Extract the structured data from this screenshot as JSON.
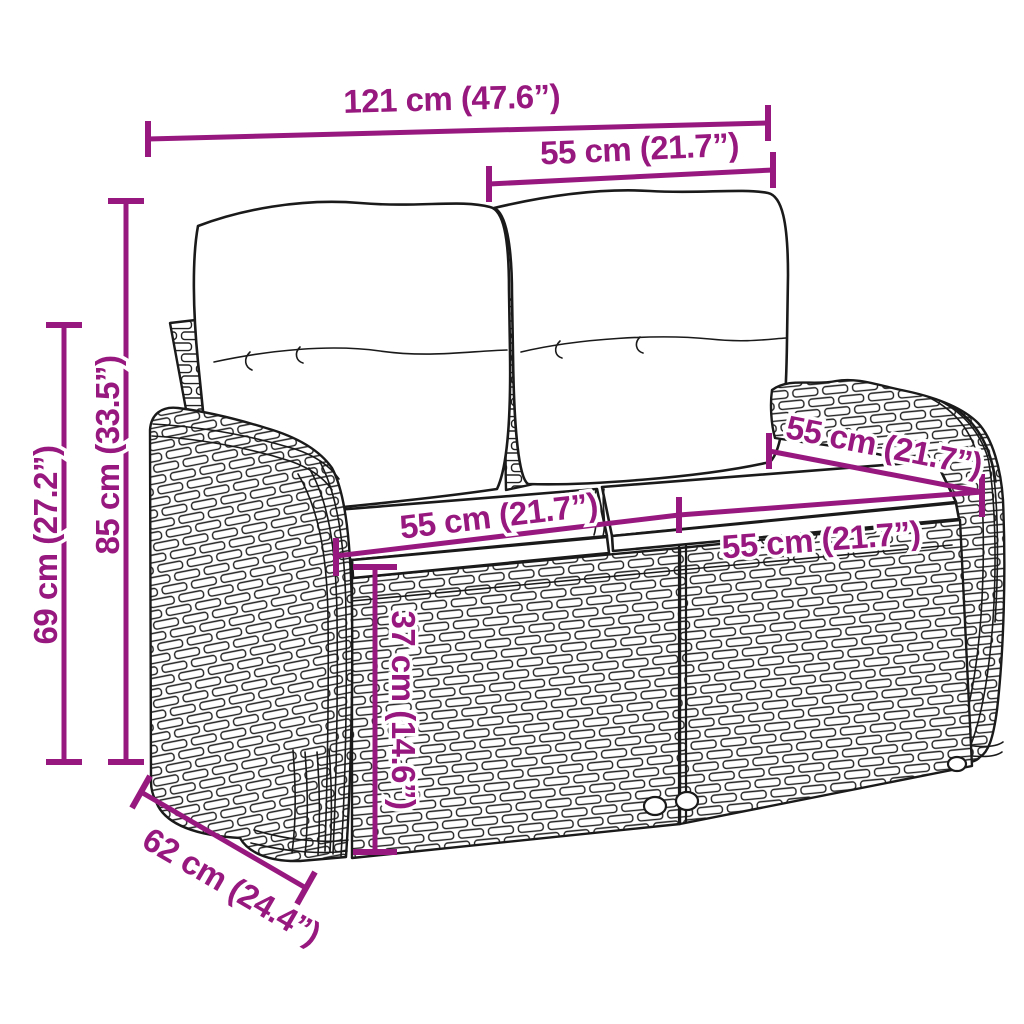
{
  "page": {
    "background": "#FFFFFF"
  },
  "style": {
    "accent_color": "#97187E",
    "line_color": "#1A1A1A"
  },
  "product": {
    "name": "2-seater poly rattan garden bench with back and seat cushions"
  },
  "dimensions": [
    {
      "id": "overall-width",
      "label": "121 cm (47.6”)"
    },
    {
      "id": "backrest-section-width",
      "label": "55 cm (21.7”)"
    },
    {
      "id": "overall-height",
      "label": "85 cm (33.5”)"
    },
    {
      "id": "armrest-height",
      "label": "69 cm (27.2”)"
    },
    {
      "id": "seat-width-left",
      "label": "55 cm (21.7”)"
    },
    {
      "id": "seat-width-right",
      "label": "55 cm (21.7”)"
    },
    {
      "id": "seat-depth",
      "label": "55 cm (21.7”)"
    },
    {
      "id": "seat-height",
      "label": "37 cm (14.6”)"
    },
    {
      "id": "base-depth",
      "label": "62 cm (24.4”)"
    }
  ]
}
